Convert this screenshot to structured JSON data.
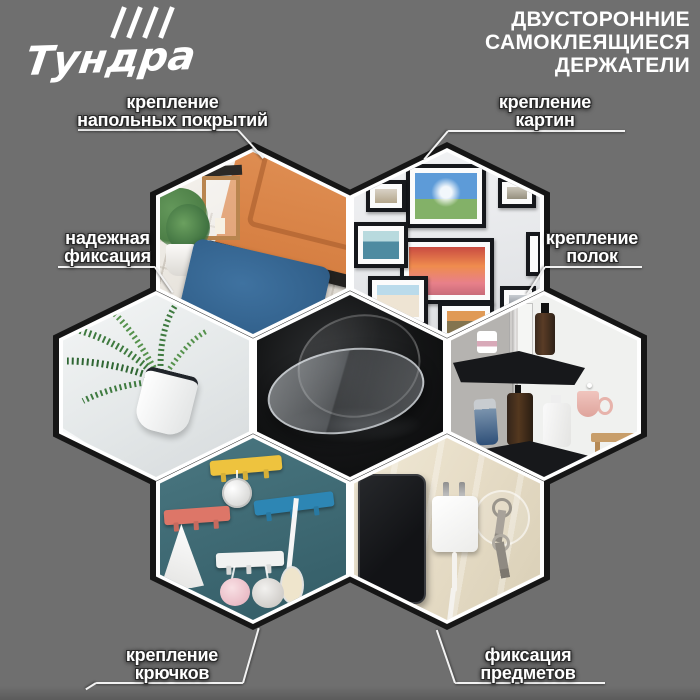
{
  "brand": {
    "logo_text": "Тундра",
    "logo_icon": "four-slashes"
  },
  "header": {
    "title_lines": [
      "ДВУСТОРОННИЕ",
      "САМОКЛЕЯЩИЕСЯ",
      "ДЕРЖАТЕЛИ"
    ]
  },
  "callouts": {
    "floor_coverings": {
      "lines": [
        "крепление",
        "напольных покрытий"
      ]
    },
    "pictures": {
      "lines": [
        "крепление",
        "картин"
      ]
    },
    "fixation": {
      "lines": [
        "надежная",
        "фиксация"
      ]
    },
    "shelves": {
      "lines": [
        "крепление",
        "полок"
      ]
    },
    "hooks": {
      "lines": [
        "крепление",
        "крючков"
      ]
    },
    "objects": {
      "lines": [
        "фиксация",
        "предметов"
      ]
    }
  },
  "hexagons": [
    {
      "id": "center-product",
      "description": "transparent double-sided adhesive disc on black background"
    },
    {
      "id": "floor-mat",
      "description": "blue doormat on white tiled floor at orange front door"
    },
    {
      "id": "picture-frames",
      "description": "gallery wall of black framed photos"
    },
    {
      "id": "plant-pot",
      "description": "white wall-mounted pot with green palm plant"
    },
    {
      "id": "corner-shelves",
      "description": "black corner shelves with cosmetic bottles"
    },
    {
      "id": "hook-racks",
      "description": "colorful hook racks with sponges and towel on teal wall"
    },
    {
      "id": "phone-charger",
      "description": "phone, charger and keys fixed to beige wall"
    }
  ],
  "colors": {
    "background": "#6f6f6f",
    "hex_border": "#ffffff",
    "hex_seam": "#161616",
    "text": "#ffffff",
    "door_orange": "#dd8a52",
    "mat_blue": "#35648f",
    "wall_teal": "#3d6a74"
  }
}
